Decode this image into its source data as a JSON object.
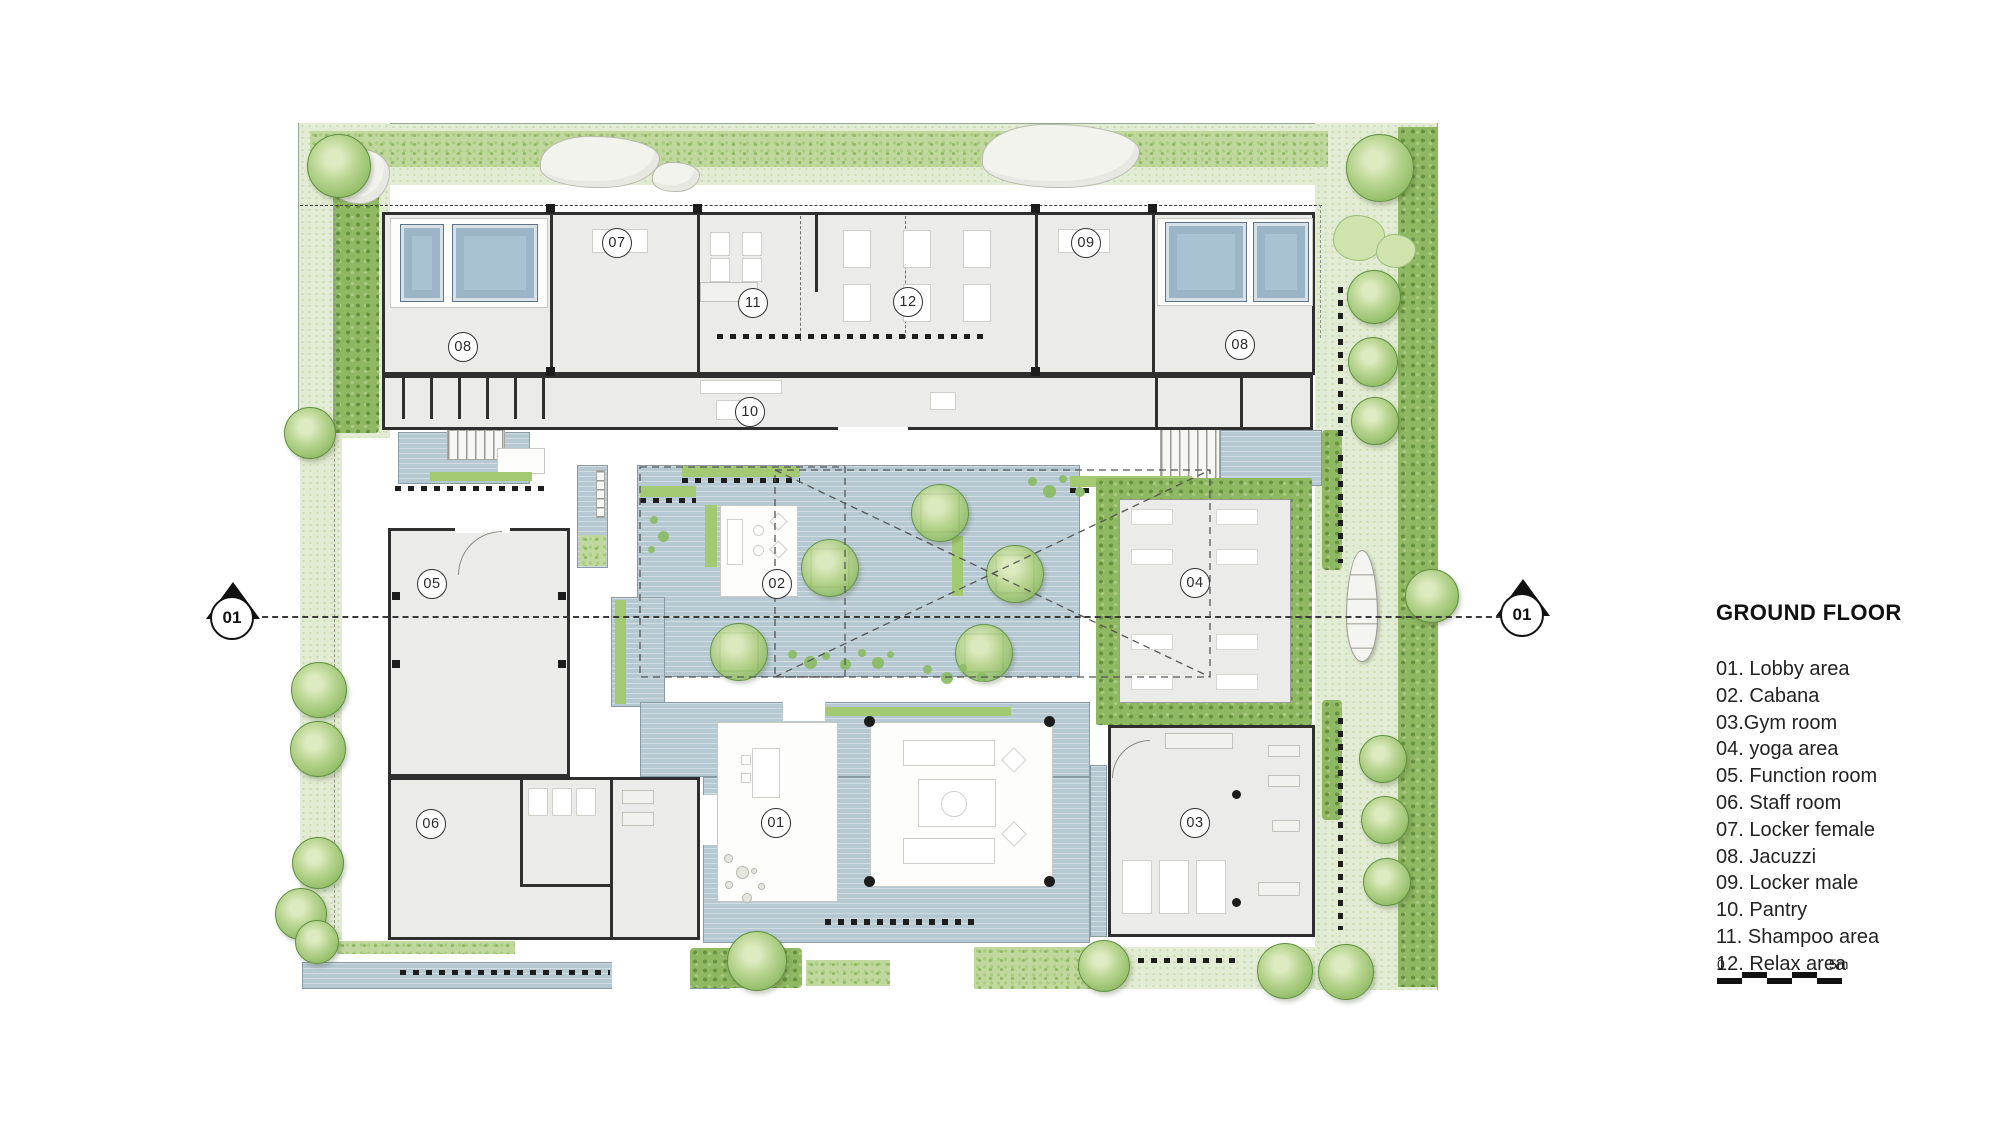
{
  "legend": {
    "title": "GROUND FLOOR",
    "items": [
      "01. Lobby area",
      "02. Cabana",
      "03.Gym room",
      "04. yoga area",
      "05. Function room",
      "06. Staff room",
      "07. Locker female",
      "08. Jacuzzi",
      "09. Locker male",
      "10. Pantry",
      "11. Shampoo area",
      "12. Relax area"
    ],
    "scale_start": "0",
    "scale_end": "5m"
  },
  "plan": {
    "section_marker_left": "01",
    "section_marker_right": "01",
    "room_labels": {
      "lobby": "01",
      "cabana": "02",
      "gym": "03",
      "yoga": "04",
      "function_room": "05",
      "staff_room": "06",
      "locker_female": "07",
      "jacuzzi_left": "08",
      "jacuzzi_right": "08",
      "locker_male": "09",
      "pantry": "10",
      "shampoo": "11",
      "relax": "12"
    },
    "colors": {
      "vegetation_light": "#e2ebd3",
      "vegetation_hedge": "#c0d89d",
      "vegetation_dark": "#8fb862",
      "tree": "#a5cb7d",
      "water": "#b6c8d2",
      "pool": "#a9c2d3",
      "wall": "#2f2f2f",
      "building_fill": "#ebebe9"
    }
  }
}
